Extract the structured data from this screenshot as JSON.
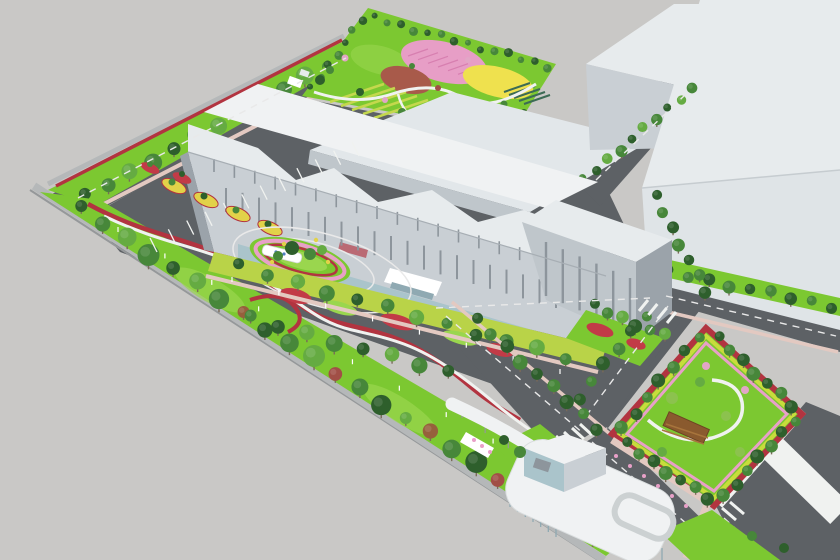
{
  "meta": {
    "title": "Aerial 3D architectural rendering of an industrial campus with landscaped gardens",
    "description": "Bird's-eye perspective rendering: large white factory buildings, a rooftop flower park with pink, red and yellow planting fields, tree-lined internal roads, an oval traffic roundabout with a signage wall, angled parking with planted islands, a rectangular entry garden with a wooden pergola, and a white curved entrance gatehouse with a long walkway canopy.",
    "canvas_width": 840,
    "canvas_height": 560
  },
  "palette": {
    "bg": "#c9c8c6",
    "asphalt": "#5d6165",
    "asphalt_light": "#6b6f74",
    "wall": "#b5b8b9",
    "wall_edge": "#95989a",
    "roof_white": "#f0f2f3",
    "roof_light": "#e7ebed",
    "roof_mid": "#e2e7ea",
    "face_bright": "#dfe4e7",
    "face_light": "#c9cfd4",
    "face_mid": "#bfc6cb",
    "face_dark": "#9ba3aa",
    "glass": "#aac4cb",
    "glass_dark": "#8fa9b2",
    "window": "#8d959c",
    "grass": "#7cc831",
    "grass_light": "#9ad64e",
    "grass_lime": "#b9d348",
    "tree_dark": "#2e5f2c",
    "tree_mid": "#47873a",
    "tree_light": "#65ab42",
    "tree_pale": "#8cc24e",
    "tree_autumn": "#96603c",
    "tree_red": "#a14f46",
    "blossom": "#e2a6c6",
    "hedge_red": "#b23440",
    "flower_red": "#c23b47",
    "flower_yellow": "#e2d249",
    "flower_pink": "#e8a0c8",
    "flower_lime": "#c8dc3c",
    "park_pink": "#e79ec6",
    "park_pink_hatch": "#d77fb0",
    "park_red": "#a85a4a",
    "park_yellow": "#efe14e",
    "crop_dark": "#3c6b55",
    "crop_light": "#c4d84d",
    "path_white": "#f0f2f0",
    "road_line": "#e9e9e9",
    "sidewalk_pink": "#e3c9c1",
    "pergola": "#8a5a2e",
    "pergola_light": "#a7743c",
    "sign_blue": "#4f7fc0",
    "trunk": "#7a6a58",
    "white": "#ffffff"
  },
  "scene": {
    "labels": {
      "park": "rooftop flower park with pink, red and yellow planting fields and crop rows",
      "main_building": "long white factory building with stepped parapet and glass base",
      "tall_block": "five-storey end block of main building",
      "warehouses": "two large white warehouse boxes at upper right",
      "roundabout": "oval landscaped roundabout with white signage wall",
      "parking": "angled parking bays with yellow and red planted islands",
      "left_belt": "perimeter green belt with tree row, red hedge and walking path",
      "entry_garden": "rectangular garden with winding path and wooden pergola",
      "gatehouse": "white curved-roof entrance gatehouse with skylight ring and canopy walkway",
      "boulevard": "entry boulevard with wide white sidewalk bands"
    }
  },
  "generated": {
    "t_left": {
      "kind": "row",
      "from": [
        80,
        208
      ],
      "to": [
        592,
        538
      ],
      "n": 23,
      "r": [
        6,
        11
      ],
      "colors": [
        "tree_dark",
        "tree_mid",
        "tree_light",
        "tree_mid",
        "tree_dark",
        "tree_light",
        "tree_mid",
        "tree_autumn",
        "tree_dark",
        "tree_mid",
        "tree_light",
        "tree_red",
        "tree_mid",
        "tree_dark",
        "tree_light",
        "tree_autumn",
        "tree_mid",
        "tree_dark",
        "tree_red",
        "tree_light",
        "tree_mid",
        "tree_dark",
        "tree_mid"
      ]
    },
    "t_topleft": {
      "kind": "row",
      "from": [
        86,
        196
      ],
      "to": [
        350,
        54
      ],
      "n": 13,
      "r": [
        6,
        9
      ],
      "colors": [
        "tree_dark",
        "tree_mid",
        "tree_light",
        "tree_mid"
      ]
    },
    "t_park_l": {
      "kind": "row",
      "from": [
        312,
        88
      ],
      "to": [
        362,
        20
      ],
      "n": 7,
      "r": [
        3,
        4.5
      ],
      "colors": [
        "tree_dark",
        "tree_mid"
      ]
    },
    "t_park_r": {
      "kind": "row",
      "from": [
        374,
        18
      ],
      "to": [
        548,
        66
      ],
      "n": 14,
      "r": [
        3,
        4.5
      ],
      "colors": [
        "tree_dark",
        "tree_mid"
      ]
    },
    "t_whgap": {
      "kind": "row",
      "from": [
        584,
        180
      ],
      "to": [
        692,
        88
      ],
      "n": 10,
      "r": [
        4,
        6
      ],
      "colors": [
        "tree_mid",
        "tree_dark",
        "tree_light"
      ]
    },
    "t_wallb": {
      "kind": "row",
      "from": [
        668,
        272
      ],
      "to": [
        832,
        306
      ],
      "n": 9,
      "r": [
        5,
        6.5
      ],
      "colors": [
        "tree_dark",
        "tree_mid"
      ]
    },
    "t_front": {
      "kind": "row",
      "from": [
        238,
        266
      ],
      "to": [
        566,
        358
      ],
      "n": 12,
      "r": [
        5.5,
        8
      ],
      "colors": [
        "tree_dark",
        "tree_mid",
        "tree_light",
        "tree_mid"
      ]
    },
    "t_rnd_sw": {
      "kind": "row",
      "from": [
        250,
        318
      ],
      "to": [
        448,
        372
      ],
      "n": 8,
      "r": [
        6,
        8.5
      ],
      "colors": [
        "tree_mid",
        "tree_dark",
        "tree_light"
      ]
    },
    "t_gateroad": {
      "kind": "row",
      "from": [
        476,
        320
      ],
      "to": [
        598,
        428
      ],
      "n": 9,
      "r": [
        5.5,
        7.5
      ],
      "colors": [
        "tree_dark",
        "tree_mid"
      ]
    },
    "t_a5_left": {
      "kind": "row",
      "from": [
        645,
        315
      ],
      "to": [
        578,
        398
      ],
      "n": 6,
      "r": [
        5,
        7
      ],
      "colors": [
        "tree_mid",
        "tree_dark"
      ]
    },
    "t_bldg_r": {
      "kind": "row",
      "from": [
        655,
        196
      ],
      "to": [
        706,
        292
      ],
      "n": 7,
      "r": [
        5,
        6.5
      ],
      "colors": [
        "tree_dark",
        "tree_mid"
      ]
    },
    "t_g2_ne": {
      "kind": "row",
      "from": [
        718,
        338
      ],
      "to": [
        792,
        406
      ],
      "n": 7,
      "r": [
        5,
        7
      ],
      "colors": [
        "tree_dark",
        "tree_mid"
      ]
    },
    "t_g2_nw": {
      "kind": "row",
      "from": [
        698,
        336
      ],
      "to": [
        622,
        428
      ],
      "n": 7,
      "r": [
        5,
        7
      ],
      "colors": [
        "tree_mid",
        "tree_dark"
      ]
    },
    "t_g2_sw": {
      "kind": "row",
      "from": [
        626,
        444
      ],
      "to": [
        708,
        498
      ],
      "n": 7,
      "r": [
        5,
        7
      ],
      "colors": [
        "tree_dark",
        "tree_mid"
      ]
    },
    "t_g2_se": {
      "kind": "row",
      "from": [
        794,
        420
      ],
      "to": [
        724,
        496
      ],
      "n": 7,
      "r": [
        5,
        7
      ],
      "colors": [
        "tree_mid",
        "tree_dark"
      ]
    },
    "t_end": {
      "kind": "row",
      "from": [
        594,
        306
      ],
      "to": [
        664,
        336
      ],
      "n": 6,
      "r": [
        5,
        7
      ],
      "colors": [
        "tree_dark",
        "tree_mid",
        "tree_light"
      ]
    },
    "t_park_scatter": {
      "kind": "circles",
      "items": [
        [
          330,
          70,
          4,
          "tree_mid"
        ],
        [
          345,
          58,
          3.5,
          "blossom"
        ],
        [
          360,
          92,
          4,
          "tree_dark"
        ],
        [
          385,
          100,
          3,
          "blossom"
        ],
        [
          402,
          112,
          4,
          "tree_mid"
        ],
        [
          430,
          120,
          3.5,
          "blossom"
        ],
        [
          455,
          126,
          4,
          "tree_dark"
        ],
        [
          472,
          108,
          3,
          "tree_light"
        ],
        [
          438,
          88,
          3,
          "tree_red"
        ],
        [
          412,
          66,
          3,
          "tree_mid"
        ],
        [
          468,
          60,
          3,
          "blossom"
        ],
        [
          504,
          104,
          3.5,
          "tree_mid"
        ],
        [
          524,
          112,
          3,
          "tree_dark"
        ],
        [
          320,
          80,
          5,
          "tree_dark"
        ]
      ]
    },
    "t_g2_inner": {
      "kind": "circles",
      "items": [
        [
          672,
          398,
          6,
          "tree_pale"
        ],
        [
          700,
          382,
          5,
          "tree_light"
        ],
        [
          726,
          416,
          5,
          "tree_pale"
        ],
        [
          662,
          452,
          5,
          "tree_light"
        ],
        [
          740,
          452,
          5,
          "tree_pale"
        ],
        [
          706,
          366,
          4,
          "blossom"
        ],
        [
          745,
          390,
          4,
          "blossom"
        ]
      ]
    },
    "t_rnd_island": {
      "kind": "circles",
      "items": [
        [
          292,
          248,
          7,
          "tree_dark"
        ],
        [
          310,
          254,
          6,
          "tree_mid"
        ],
        [
          278,
          256,
          5,
          "tree_mid"
        ],
        [
          322,
          250,
          5,
          "tree_light"
        ]
      ]
    },
    "t_islands": {
      "kind": "circles",
      "items": [
        [
          172,
          182,
          3.5,
          "tree_mid"
        ],
        [
          204,
          196,
          3.5,
          "tree_dark"
        ],
        [
          236,
          210,
          3.5,
          "tree_mid"
        ],
        [
          268,
          224,
          3.5,
          "tree_dark"
        ],
        [
          150,
          164,
          3,
          "tree_mid"
        ],
        [
          182,
          174,
          3,
          "tree_dark"
        ]
      ]
    },
    "t_gate": {
      "kind": "circles",
      "items": [
        [
          520,
          452,
          6,
          "tree_mid"
        ],
        [
          504,
          440,
          5,
          "tree_dark"
        ],
        [
          752,
          536,
          5,
          "tree_mid"
        ],
        [
          784,
          548,
          5,
          "tree_dark"
        ]
      ]
    },
    "s_stalls": {
      "kind": "stripes",
      "from": [
        150,
        238
      ],
      "to": [
        352,
        142
      ],
      "n": 12,
      "vec": [
        7,
        14
      ],
      "w": 1.3,
      "color": "path_white"
    },
    "s_win1": {
      "kind": "stripes",
      "from": [
        226,
        212
      ],
      "to": [
        556,
        308
      ],
      "n": 21,
      "vec": [
        0,
        -24
      ],
      "w": 2,
      "color": "window"
    },
    "s_win2": {
      "kind": "stripes",
      "from": [
        214,
        172
      ],
      "to": [
        540,
        266
      ],
      "n": 17,
      "vec": [
        0,
        -13
      ],
      "w": 1.6,
      "color": "window"
    },
    "s_win_tall": {
      "kind": "stripes",
      "from": [
        546,
        296
      ],
      "to": [
        630,
        332
      ],
      "n": 6,
      "vec": [
        0,
        -54
      ],
      "w": 2.4,
      "color": "window"
    },
    "s_crops": {
      "kind": "stripes",
      "from": [
        330,
        102
      ],
      "to": [
        396,
        126
      ],
      "n": 7,
      "vec": [
        54,
        -18
      ],
      "w": 2.6,
      "color": "crop_light"
    },
    "s_crops_dark": {
      "kind": "stripes",
      "from": [
        504,
        92
      ],
      "to": [
        524,
        104
      ],
      "n": 5,
      "vec": [
        26,
        -9
      ],
      "w": 2,
      "color": "crop_dark"
    },
    "s_pink_hatch": {
      "kind": "stripes",
      "from": [
        408,
        56
      ],
      "to": [
        468,
        78
      ],
      "n": 7,
      "vec": [
        20,
        -7
      ],
      "w": 1.2,
      "color": "park_pink_hatch"
    },
    "s_cross_gate": {
      "kind": "stripes",
      "from": [
        548,
        440
      ],
      "to": [
        580,
        424
      ],
      "n": 5,
      "vec": [
        12,
        11
      ],
      "w": 3,
      "color": "path_white"
    },
    "s_cross_j": {
      "kind": "stripes",
      "from": [
        648,
        300
      ],
      "to": [
        676,
        312
      ],
      "n": 4,
      "vec": [
        -9,
        11
      ],
      "w": 3,
      "color": "path_white"
    },
    "s_cross_r": {
      "kind": "stripes",
      "from": [
        706,
        520
      ],
      "to": [
        730,
        502
      ],
      "n": 4,
      "vec": [
        14,
        12
      ],
      "w": 3,
      "color": "path_white"
    },
    "s_lamps1": {
      "kind": "stripes",
      "from": [
        118,
        232
      ],
      "to": [
        540,
        470
      ],
      "n": 10,
      "vec": [
        0,
        -5
      ],
      "w": 1.2,
      "color": "white"
    },
    "s_lamps2": {
      "kind": "stripes",
      "from": [
        232,
        282
      ],
      "to": [
        560,
        374
      ],
      "n": 8,
      "vec": [
        0,
        -5
      ],
      "w": 1.2,
      "color": "white"
    },
    "s_canopy_posts": {
      "kind": "stripes",
      "from": [
        462,
        412
      ],
      "to": [
        624,
        518
      ],
      "n": 8,
      "vec": [
        0,
        6
      ],
      "w": 1.2,
      "color": "wall_edge"
    },
    "s_gate_glass1": {
      "kind": "stripes",
      "from": [
        510,
        494
      ],
      "to": [
        556,
        524
      ],
      "n": 7,
      "vec": [
        0,
        13
      ],
      "w": 1.3,
      "color": "glass_dark"
    },
    "s_gate_glass2": {
      "kind": "stripes",
      "from": [
        600,
        524
      ],
      "to": [
        662,
        548
      ],
      "n": 8,
      "vec": [
        0,
        12
      ],
      "w": 1.3,
      "color": "glass_dark"
    },
    "d_a1": {
      "kind": "dash",
      "pts": [
        [
          78,
          198
        ],
        [
          346,
          58
        ]
      ]
    },
    "d_mid": {
      "kind": "dash",
      "pts": [
        [
          436,
          308
        ],
        [
          650,
          298
        ]
      ]
    },
    "d_a4": {
      "kind": "dash",
      "pts": [
        [
          666,
          296
        ],
        [
          836,
          336
        ]
      ]
    },
    "d_a5": {
      "kind": "dash",
      "pts": [
        [
          668,
          306
        ],
        [
          586,
          416
        ]
      ]
    },
    "d_a6": {
      "kind": "dash",
      "pts": [
        [
          446,
          316
        ],
        [
          584,
          434
        ]
      ]
    },
    "d_a7": {
      "kind": "dash",
      "pts": [
        [
          596,
          180
        ],
        [
          686,
          94
        ]
      ]
    },
    "d_a9": {
      "kind": "dash",
      "pts": [
        [
          592,
          442
        ],
        [
          724,
          556
        ]
      ]
    },
    "d_blvd": {
      "kind": "dash",
      "pts": [
        [
          724,
          518
        ],
        [
          770,
          560
        ]
      ]
    },
    "f_rnd_yellow": {
      "kind": "dots",
      "color": "flower_yellow",
      "items": [
        [
          284,
          244,
          2.2
        ],
        [
          316,
          240,
          2.2
        ],
        [
          328,
          262,
          2.2
        ],
        [
          272,
          262,
          2.2
        ]
      ]
    },
    "f_sign_blue": {
      "kind": "dots",
      "color": "sign_blue",
      "items": [
        [
          276,
          252,
          1.6
        ],
        [
          284,
          254,
          1.6
        ]
      ]
    },
    "f_gate_pink": {
      "kind": "dots",
      "color": "flower_pink",
      "items": [
        [
          482,
          446,
          2
        ],
        [
          474,
          440,
          2
        ],
        [
          490,
          452,
          2
        ]
      ]
    },
    "f_g2_pink": {
      "kind": "dots",
      "color": "flower_pink",
      "items": [
        [
          616,
          456,
          2
        ],
        [
          630,
          466,
          2
        ],
        [
          644,
          476,
          2
        ],
        [
          658,
          486,
          2
        ],
        [
          672,
          496,
          2
        ],
        [
          686,
          506,
          2
        ]
      ]
    }
  }
}
